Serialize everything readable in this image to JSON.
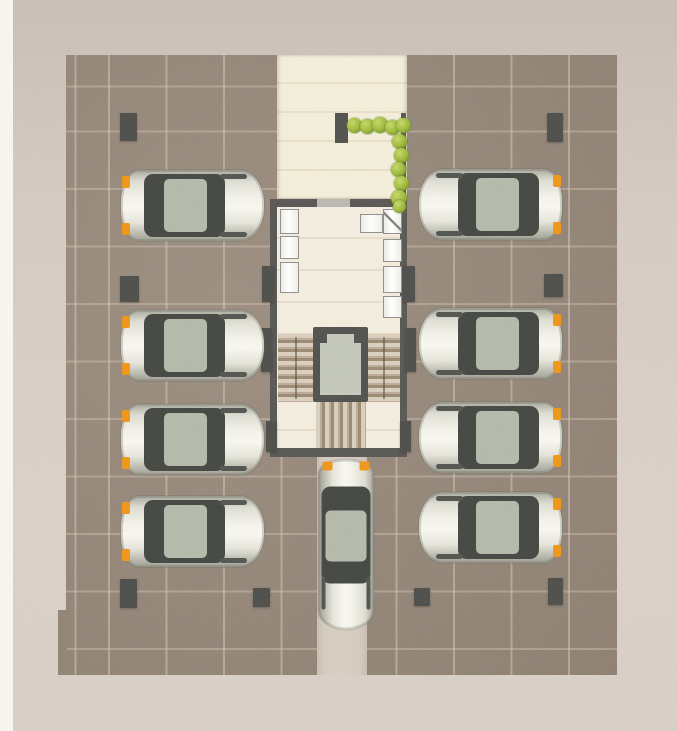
{
  "meta": {
    "type": "architectural-floor-plan",
    "view": "top-down parking level with central stair and elevator core",
    "parked_car_count": 8,
    "moving_car_count": 1,
    "pillar_count": 14,
    "hedge_bush_count": 11
  },
  "colors": {
    "background": "#d2c8bf",
    "margin_strip": "#f7f3ed",
    "pavement": "#918375",
    "pavement_grid": "#d6c7b4",
    "walkway": "#f2ecd8",
    "building_floor": "#f1ebdc",
    "wall": "#555450",
    "pillar": "#4b4b48",
    "cabinet_panel": "#ffffff",
    "elevator_cab": "#c2c6b9",
    "stair_light": "#d8ccba",
    "stair_dark": "#99886f",
    "hedge_green": "#9ab73a",
    "car_body": "#f2f2e9",
    "car_glass": "#42453f",
    "car_roof": "#b2b7a8",
    "signal_orange": "#ee9318",
    "ramp": "#d2c8bc"
  },
  "plan": {
    "canvas": {
      "width": 677,
      "height": 731
    },
    "parked_cars": [
      {
        "id": "left-1",
        "facing": "left",
        "x": 121,
        "y": 170,
        "length": 143,
        "width": 71
      },
      {
        "id": "left-2",
        "facing": "left",
        "x": 121,
        "y": 310,
        "length": 143,
        "width": 71
      },
      {
        "id": "left-3",
        "facing": "left",
        "x": 121,
        "y": 404,
        "length": 143,
        "width": 71
      },
      {
        "id": "left-4",
        "facing": "left",
        "x": 121,
        "y": 496,
        "length": 143,
        "width": 71
      },
      {
        "id": "right-1",
        "facing": "right",
        "x": 419,
        "y": 169,
        "length": 143,
        "width": 71
      },
      {
        "id": "right-2",
        "facing": "right",
        "x": 419,
        "y": 308,
        "length": 143,
        "width": 71
      },
      {
        "id": "right-3",
        "facing": "right",
        "x": 419,
        "y": 402,
        "length": 143,
        "width": 71
      },
      {
        "id": "right-4",
        "facing": "right",
        "x": 419,
        "y": 492,
        "length": 143,
        "width": 71
      }
    ],
    "moving_car": {
      "id": "ramp-car",
      "facing": "up",
      "x": 261,
      "y": 517,
      "length": 170,
      "width": 55
    },
    "pillars": [
      {
        "x": 120,
        "y": 113,
        "w": 17,
        "h": 28
      },
      {
        "x": 547,
        "y": 113,
        "w": 16,
        "h": 29
      },
      {
        "x": 120,
        "y": 276,
        "w": 19,
        "h": 26
      },
      {
        "x": 544,
        "y": 274,
        "w": 19,
        "h": 23
      },
      {
        "x": 120,
        "y": 579,
        "w": 17,
        "h": 29
      },
      {
        "x": 548,
        "y": 578,
        "w": 15,
        "h": 27
      },
      {
        "x": 253,
        "y": 588,
        "w": 17,
        "h": 19
      },
      {
        "x": 414,
        "y": 588,
        "w": 16,
        "h": 18
      },
      {
        "x": 262,
        "y": 266,
        "w": 12,
        "h": 36
      },
      {
        "x": 403,
        "y": 266,
        "w": 12,
        "h": 36
      },
      {
        "x": 261,
        "y": 328,
        "w": 11,
        "h": 44
      },
      {
        "x": 405,
        "y": 328,
        "w": 11,
        "h": 44
      },
      {
        "x": 266,
        "y": 421,
        "w": 11,
        "h": 31
      },
      {
        "x": 400,
        "y": 421,
        "w": 11,
        "h": 31
      }
    ],
    "hedge_bushes": [
      {
        "x": 347,
        "y": 118,
        "s": 15
      },
      {
        "x": 360,
        "y": 119,
        "s": 15
      },
      {
        "x": 372,
        "y": 117,
        "s": 16
      },
      {
        "x": 385,
        "y": 120,
        "s": 15
      },
      {
        "x": 396,
        "y": 118,
        "s": 15
      },
      {
        "x": 392,
        "y": 134,
        "s": 15
      },
      {
        "x": 394,
        "y": 148,
        "s": 15
      },
      {
        "x": 391,
        "y": 162,
        "s": 15
      },
      {
        "x": 394,
        "y": 176,
        "s": 15
      },
      {
        "x": 391,
        "y": 190,
        "s": 16
      },
      {
        "x": 393,
        "y": 200,
        "s": 13
      }
    ],
    "cabinet_panels": [
      {
        "x": 280,
        "y": 209,
        "w": 19,
        "h": 25,
        "diag": false
      },
      {
        "x": 280,
        "y": 236,
        "w": 19,
        "h": 23,
        "diag": false
      },
      {
        "x": 280,
        "y": 262,
        "w": 19,
        "h": 31,
        "diag": false
      },
      {
        "x": 383,
        "y": 209,
        "w": 19,
        "h": 25,
        "diag": true
      },
      {
        "x": 383,
        "y": 239,
        "w": 19,
        "h": 23,
        "diag": false
      },
      {
        "x": 383,
        "y": 266,
        "w": 19,
        "h": 27,
        "diag": false
      },
      {
        "x": 383,
        "y": 296,
        "w": 19,
        "h": 22,
        "diag": false
      },
      {
        "x": 360,
        "y": 214,
        "w": 23,
        "h": 19,
        "diag": false
      }
    ],
    "side_walls": [
      {
        "x": 401,
        "y": 113,
        "w": 5,
        "h": 86
      }
    ]
  }
}
